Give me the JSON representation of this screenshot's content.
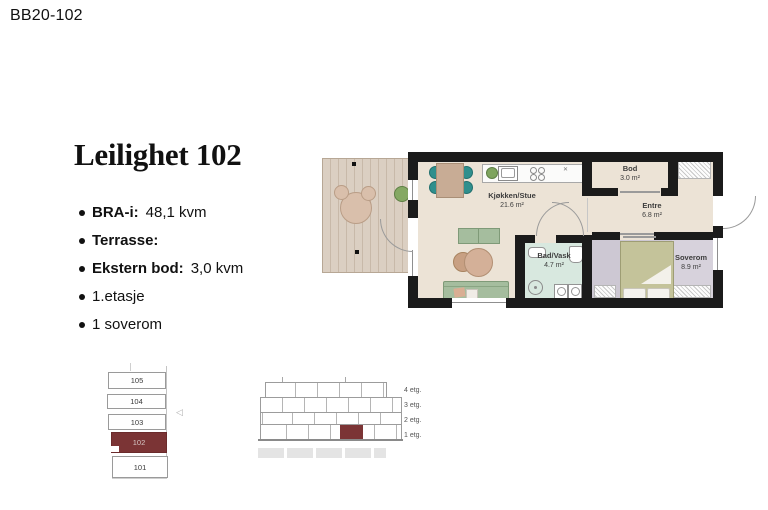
{
  "page": {
    "code": "BB20-102"
  },
  "apartment": {
    "title": "Leilighet 102",
    "specs": [
      {
        "label": "BRA-i:",
        "value": "48,1 kvm"
      },
      {
        "label": "Terrasse:",
        "value": ""
      },
      {
        "label": "Ekstern bod:",
        "value": "3,0 kvm"
      },
      {
        "label": "",
        "value": "1.etasje"
      },
      {
        "label": "",
        "value": "1 soverom"
      }
    ]
  },
  "floorplan": {
    "rooms": [
      {
        "name": "Kjøkken/Stue",
        "area": "21.6 m²"
      },
      {
        "name": "Bod",
        "area": "3.0 m²"
      },
      {
        "name": "Entre",
        "area": "6.8 m²"
      },
      {
        "name": "Bad/Vask",
        "area": "4.7 m²"
      },
      {
        "name": "Soverom",
        "area": "8.9 m²"
      }
    ],
    "kitchen_symbol": "✕"
  },
  "location_diagram": {
    "units": [
      "105",
      "104",
      "103",
      "102",
      "101"
    ],
    "highlighted_unit": "102",
    "marker": "◁"
  },
  "elevation": {
    "floor_labels": [
      "4 etg.",
      "3 etg.",
      "2 etg.",
      "1 etg."
    ]
  },
  "colors": {
    "highlight": "#7b3435",
    "wall": "#1b1b1b",
    "floor_beige": "#ece3d6",
    "terrace_tan": "#dbcfc2",
    "bath_mint": "#d8e8df",
    "bedroom_lavender": "#cdc8d3",
    "bed_olive": "#c4c39a",
    "chair_teal": "#2f8f8d",
    "sofa_sage": "#a5bd9e",
    "table_tan": "#c8ac95"
  }
}
